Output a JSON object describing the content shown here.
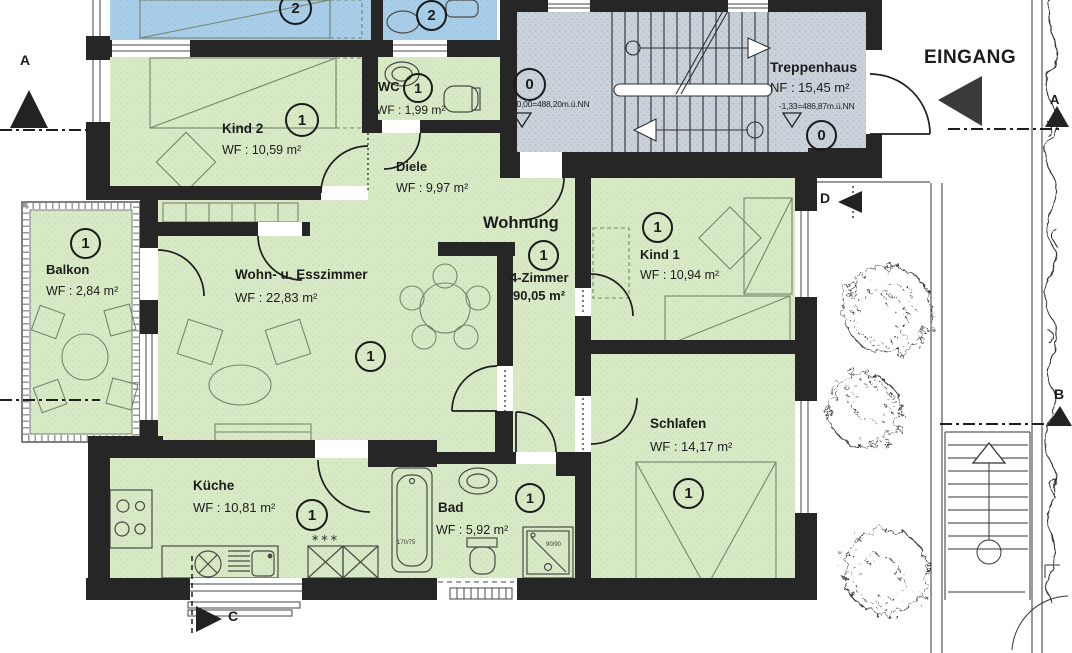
{
  "apartment": {
    "label": "Wohnung",
    "unit_type": "4-Zimmer",
    "total_area": "90,05 m²",
    "badge": "1"
  },
  "rooms": {
    "kind2": {
      "name": "Kind 2",
      "area": "WF : 10,59 m²",
      "badge": "1"
    },
    "wc": {
      "name": "WC",
      "area": "WF : 1,99 m²",
      "badge": "1"
    },
    "diele": {
      "name": "Diele",
      "area": "WF : 9,97 m²"
    },
    "treppenhaus": {
      "name": "Treppenhaus",
      "area": "NF : 15,45 m²",
      "badge_upper": "0",
      "badge_lower": "0"
    },
    "balkon": {
      "name": "Balkon",
      "area": "WF : 2,84 m²",
      "badge": "1"
    },
    "wohnzimmer": {
      "name": "Wohn- u. Esszimmer",
      "area": "WF : 22,83 m²",
      "badge": "1"
    },
    "kind1": {
      "name": "Kind 1",
      "area": "WF : 10,94 m²",
      "badge": "1"
    },
    "schlafen": {
      "name": "Schlafen",
      "area": "WF : 14,17 m²",
      "badge": "1"
    },
    "kueche": {
      "name": "Küche",
      "area": "WF : 10,81 m²",
      "badge": "1"
    },
    "bad": {
      "name": "Bad",
      "area": "WF : 5,92 m²",
      "badge": "1"
    }
  },
  "neighbor_badges": {
    "bedroom": "2",
    "bath": "2"
  },
  "annotations": {
    "entrance": "EINGANG",
    "elevation_ground": "±0,00=488,20m.ü.NN",
    "elevation_lower": "-1,33=486,87m.ü.NN",
    "freezer_stars": "∗∗∗",
    "tub_size": "170/75",
    "shower_size": "90/90"
  },
  "section_markers": {
    "a_left": "A",
    "a_right": "A",
    "b": "B",
    "c": "C",
    "d": "D"
  },
  "colors": {
    "room_green": "#d8eac5",
    "neighbor_blue": "#a8cde8",
    "stairwell_gray": "#c9d2da",
    "wall": "#262626"
  }
}
